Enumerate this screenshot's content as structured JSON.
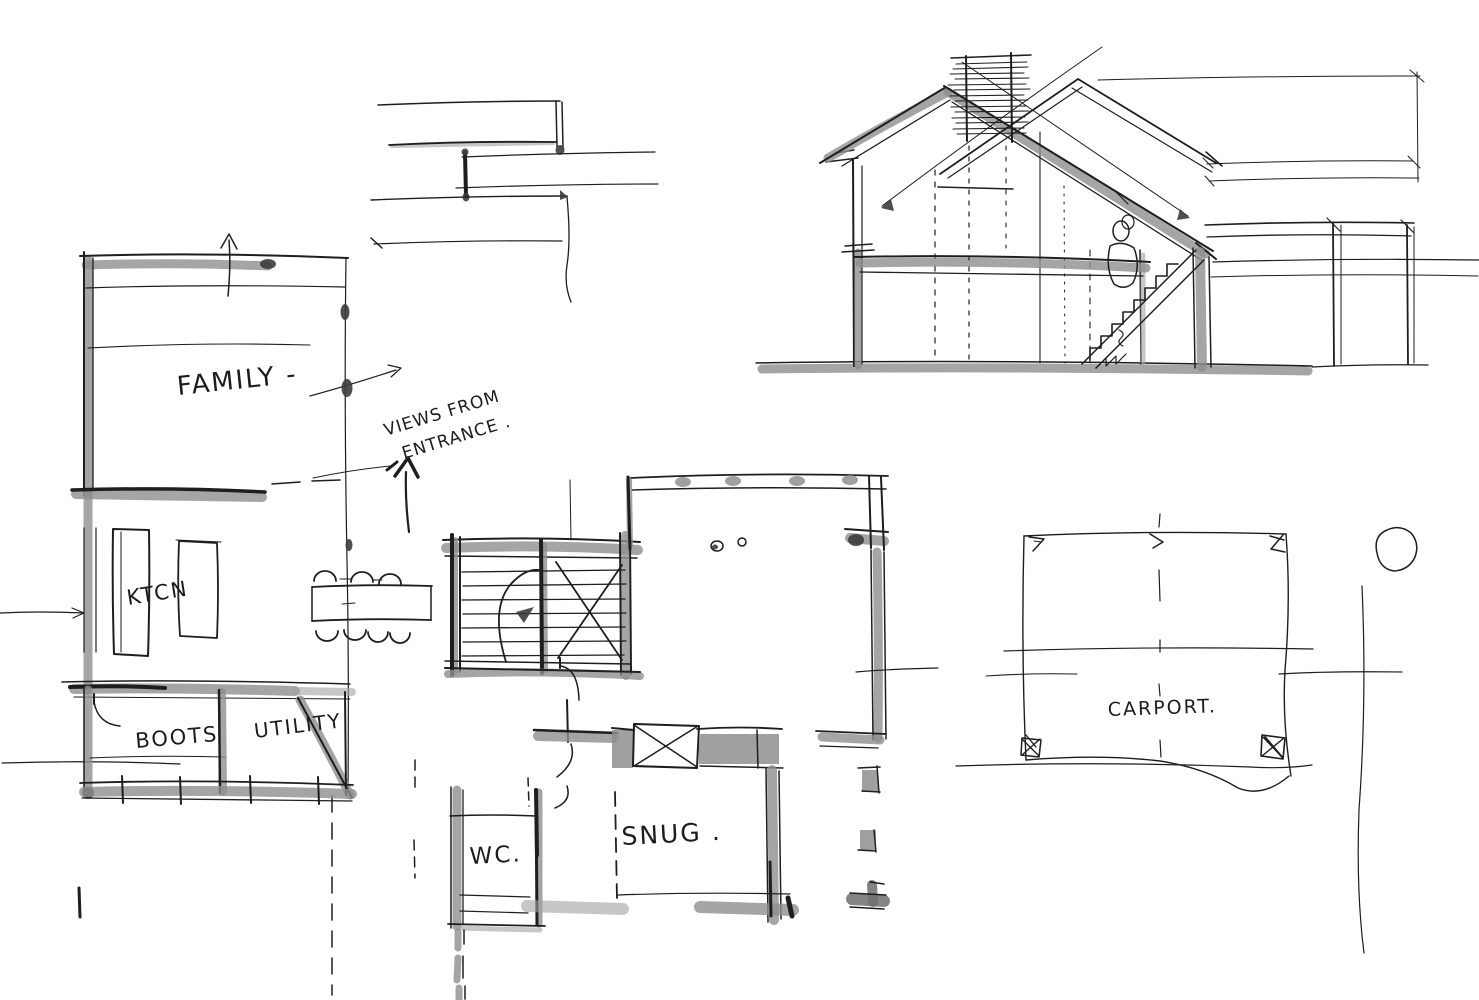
{
  "drawing": {
    "type": "hand-drawn architectural concept sketch",
    "colors": {
      "paper": "#ffffff",
      "ink": "#1e1e1e",
      "marker": "#8f8f8f"
    }
  },
  "floor_plan": {
    "family_label": "FAMILY -",
    "kitchen_label": "KTCN",
    "boots_label": "BOOTS",
    "utility_label": "UTILITY",
    "wc_label": "WC.",
    "snug_label": "SNUG .",
    "views_note": {
      "line1": "VIEWS FROM",
      "line2": "ENTRANCE ."
    }
  },
  "carport_plan": {
    "label": "CARPORT."
  }
}
